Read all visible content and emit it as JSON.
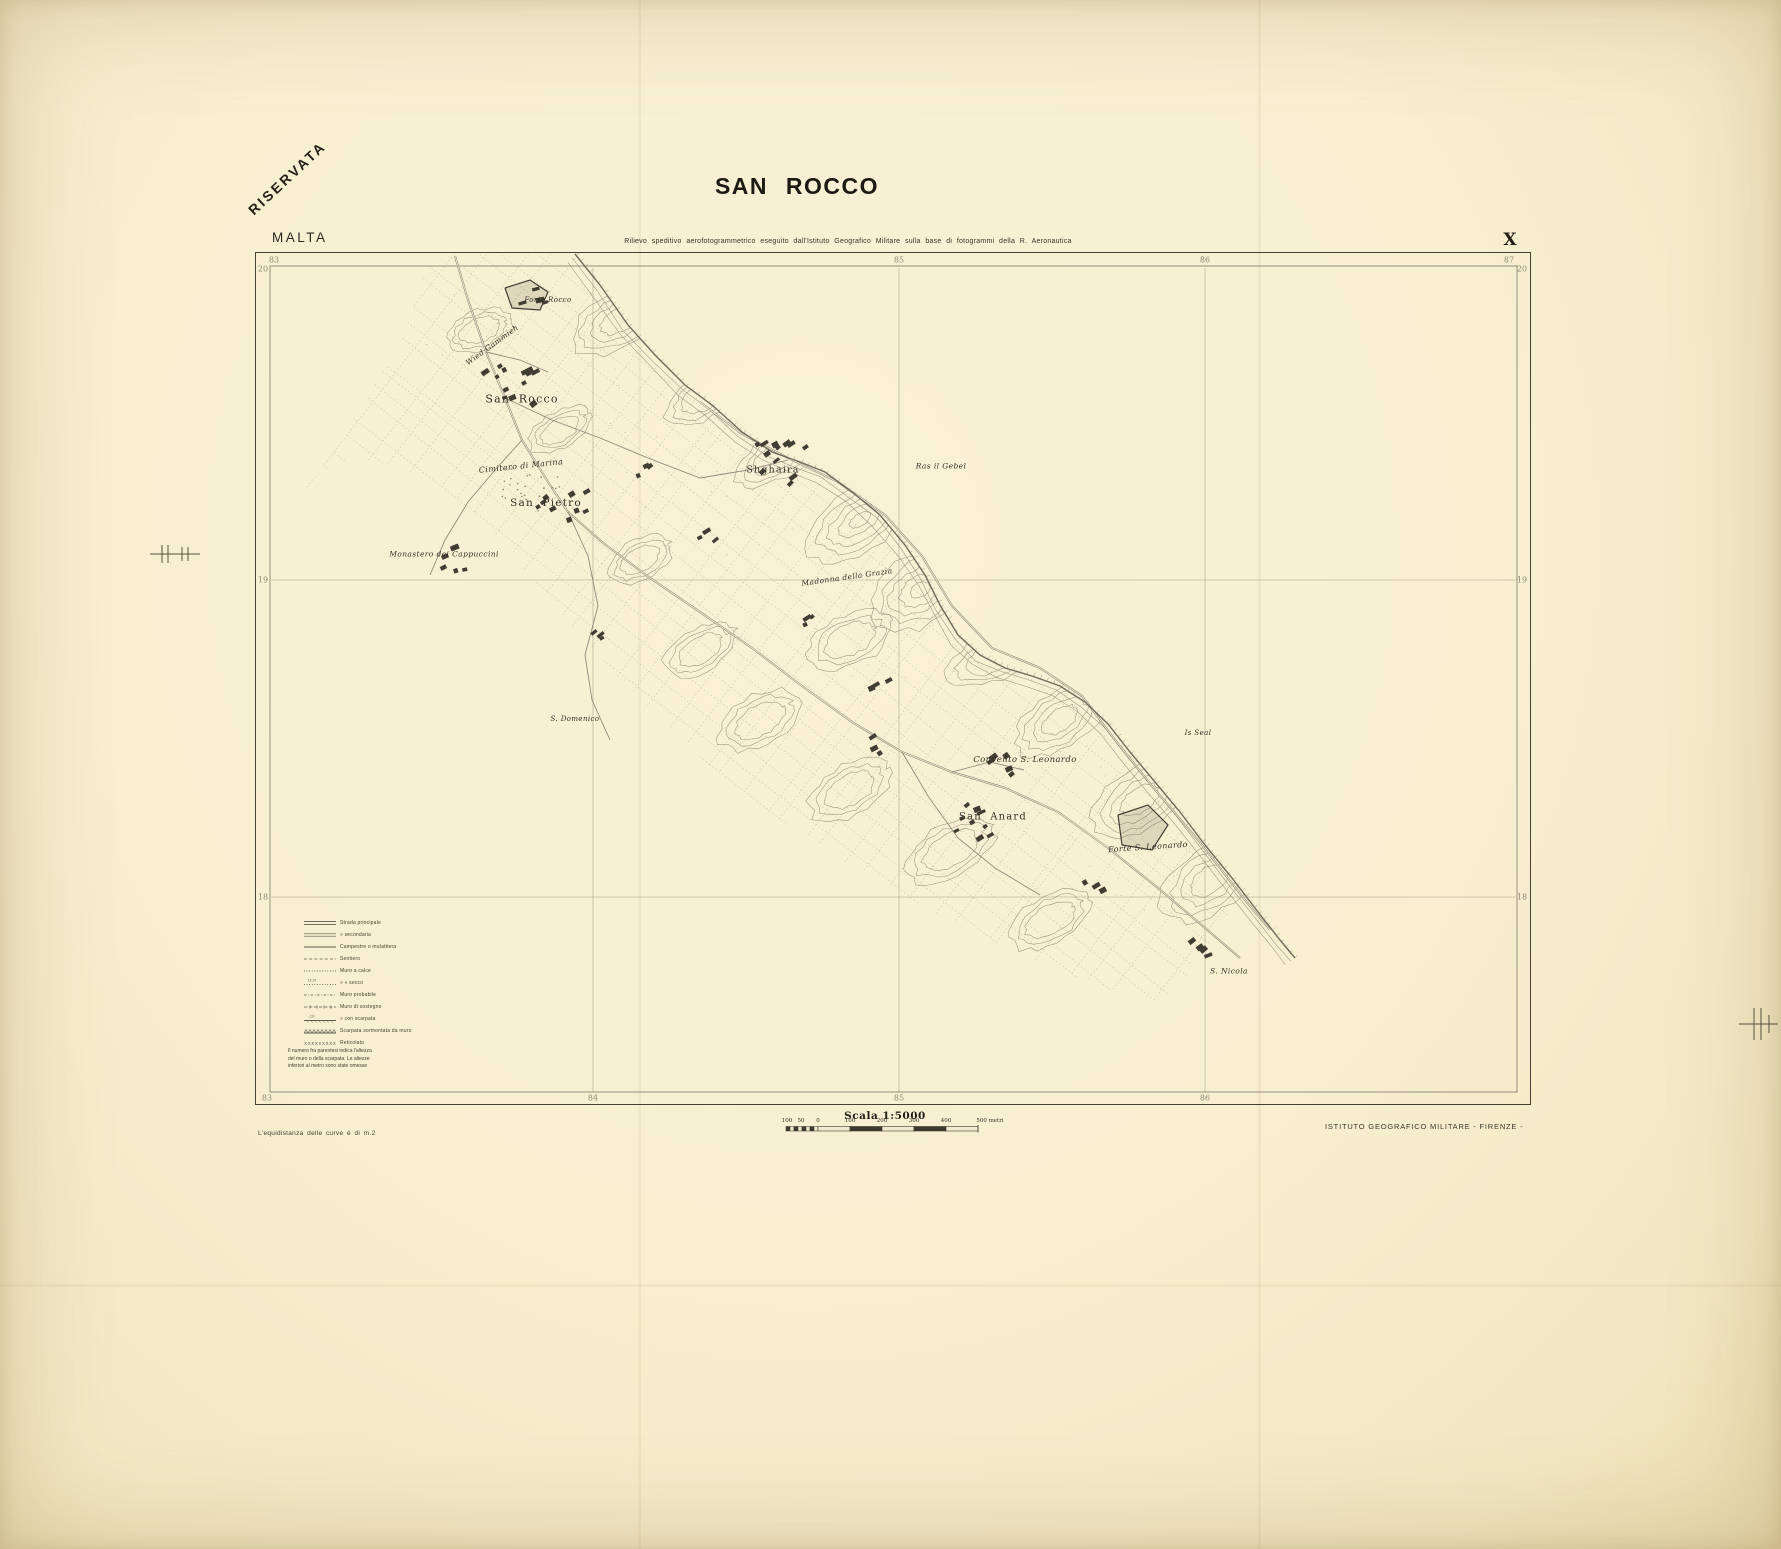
{
  "stamp": "RISERVATA",
  "region": "MALTA",
  "title": "SAN ROCCO",
  "subtitle": "Rilievo speditivo aerofotogrammetrico eseguito dall'Istituto Geografico Militare sulla base di fotogrammi della R. Aeronautica",
  "sheet_number": "X",
  "grid": {
    "top": [
      "83",
      "85",
      "86",
      "87"
    ],
    "bottom": [
      "83",
      "84",
      "85",
      "86"
    ],
    "left": [
      "20",
      "19",
      "18"
    ],
    "right": [
      "20",
      "19",
      "18"
    ]
  },
  "map_labels": [
    {
      "text": "Forte Rocco"
    },
    {
      "text": "Wied Gammieh"
    },
    {
      "text": "San Rocco"
    },
    {
      "text": "Cimitero di Marina"
    },
    {
      "text": "San Pietro"
    },
    {
      "text": "Monastero dei Cappuccini"
    },
    {
      "text": "Shghaira"
    },
    {
      "text": "Ras il Gebel"
    },
    {
      "text": "Madonna della Grazia"
    },
    {
      "text": "S. Domenico"
    },
    {
      "text": "Is Seal"
    },
    {
      "text": "Convento S. Leonardo"
    },
    {
      "text": "San Anard"
    },
    {
      "text": "Forte S. Leonardo"
    },
    {
      "text": "S. Nicola"
    }
  ],
  "legend": {
    "items": [
      {
        "symbol": "road-double",
        "label": "Strada principale",
        "note": ""
      },
      {
        "symbol": "road-double-thin",
        "label": "»    secondaria",
        "note": ""
      },
      {
        "symbol": "road-single",
        "label": "Campestre o mulattiera",
        "note": ""
      },
      {
        "symbol": "path-dashed",
        "label": "Sentiero",
        "note": ""
      },
      {
        "symbol": "wall-dotted",
        "label": "Muro a calce",
        "note": ""
      },
      {
        "symbol": "wall-dotted",
        "label": "»  »  secco",
        "note": "(3,5)"
      },
      {
        "symbol": "wall-probable",
        "label": "Muro probabile",
        "note": ""
      },
      {
        "symbol": "wall-retaining",
        "label": "Muro di sostegno",
        "note": ""
      },
      {
        "symbol": "wall-scarp",
        "label": "»  con scarpata",
        "note": "(3)"
      },
      {
        "symbol": "scarp-wall",
        "label": "Scarpata sormontata da muro",
        "note": ""
      },
      {
        "symbol": "wire-fence",
        "label": "Reticolato",
        "note": ""
      }
    ],
    "note": [
      "Il numero fra parentesi indica l'altezza",
      "del muro o della scarpata. Le altezze",
      "inferiori al metro sono state omesse"
    ]
  },
  "scale": {
    "title": "Scala  1:5000",
    "ticks": [
      "100",
      "50",
      "0",
      "100",
      "200",
      "300",
      "400",
      "500 metri"
    ]
  },
  "footer": {
    "left": "L'equidistanza delle curve è di m.2",
    "right": "ISTITUTO GEOGRAFICO MILITARE - FIRENZE -"
  },
  "colors": {
    "paper": "#f8efd1",
    "ink": "#221f18",
    "map_line": "#6f6a5b",
    "map_line_light": "#8a8373",
    "building": "#413d33"
  }
}
